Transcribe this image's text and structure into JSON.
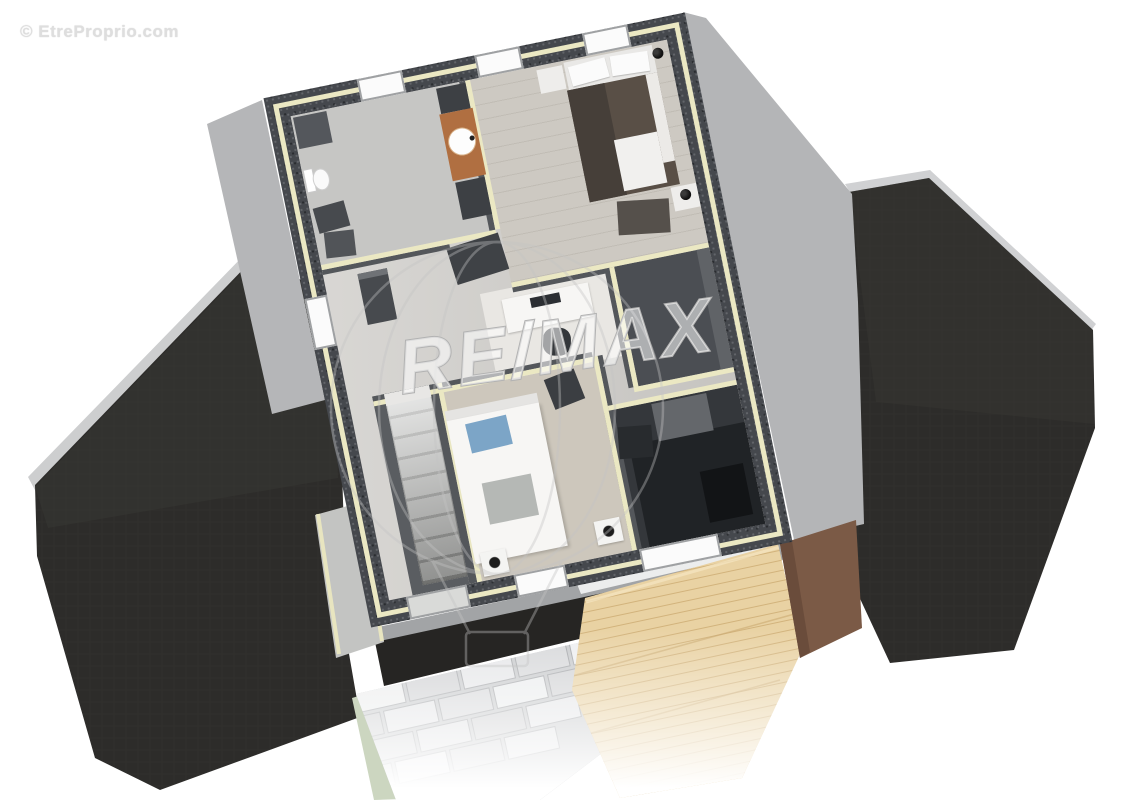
{
  "window": {
    "width": 1122,
    "height": 800,
    "background": "#ffffff"
  },
  "watermarks": {
    "copyright": "© EtreProprio.com",
    "brand": "RE/MAX"
  },
  "scene": {
    "description": "3D aerial cutaway floor plan render of a house upper storey",
    "objects": [
      "left-hip-roof",
      "right-hip-roof",
      "speckled-exterior-walls",
      "cream-wall-trim",
      "bathroom-with-toilet-and-round-sink-vanity",
      "double-bed-with-black-lamps",
      "dark-dressing-room",
      "dark-storage-room",
      "single-bed-with-blue-pillow",
      "desk-with-chair",
      "staircase",
      "exterior-stair-strip",
      "wooden-terrace",
      "stone-paver-path",
      "brown-garage-door",
      "re-max-balloon-watermark"
    ]
  },
  "palette": {
    "roof": "#2d2c2a",
    "exterior_wall": "#45484d",
    "wall_trim_cream": "#ebe8c3",
    "floor_light": "#cfcdc9",
    "floor_wood": "#cdc9c2",
    "floor_dark_room": "#34373b",
    "deck_wood": "#e9d2a3",
    "stone_path": "#dfe0e3",
    "door_brown": "#7b5a46",
    "pillow_blue": "#7ca5c7",
    "vanity_wood": "#b06f41",
    "watermark_gray": "#c4c4c4"
  }
}
